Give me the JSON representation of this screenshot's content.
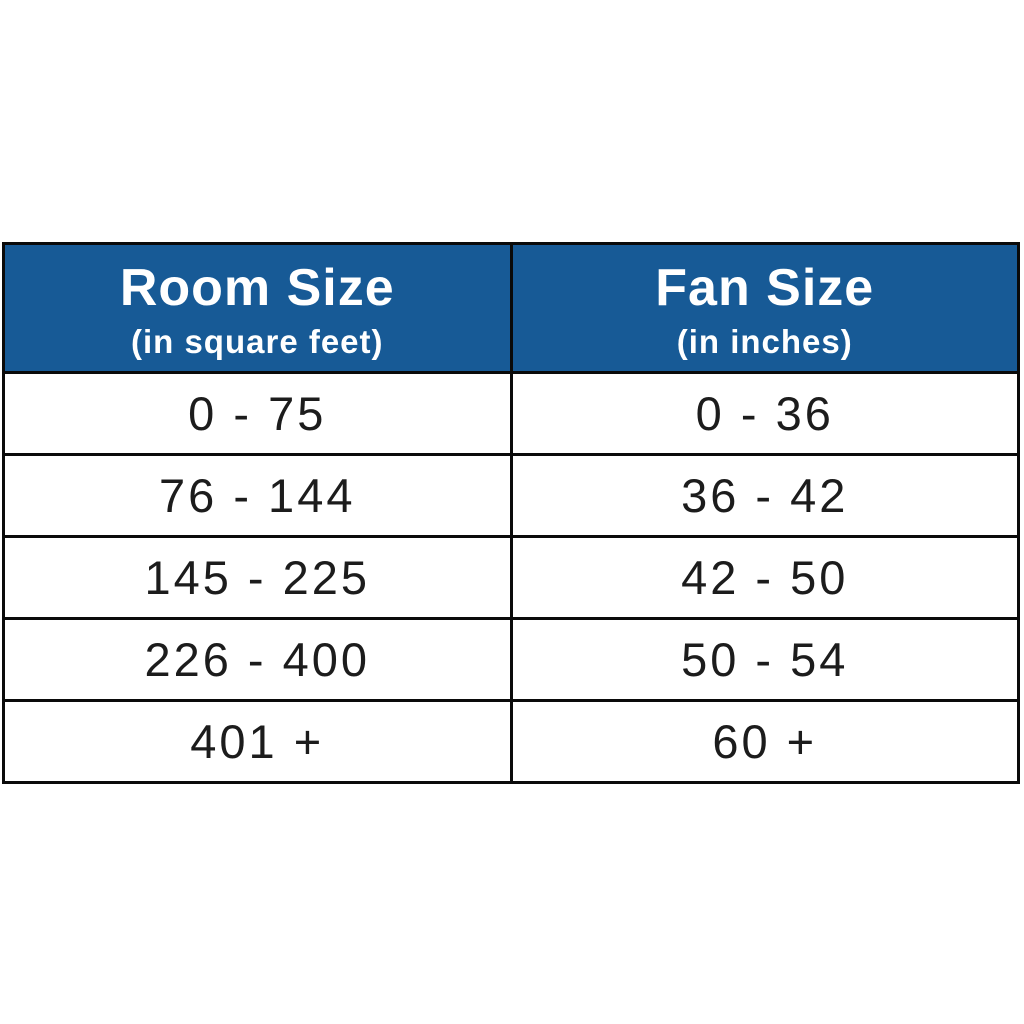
{
  "chart_data": {
    "type": "table",
    "title": "Room Size to Fan Size conversion table",
    "columns": [
      {
        "title": "Room Size",
        "subtitle": "(in square feet)"
      },
      {
        "title": "Fan Size",
        "subtitle": "(in inches)"
      }
    ],
    "rows": [
      [
        "0 - 75",
        "0 - 36"
      ],
      [
        "76 - 144",
        "36 - 42"
      ],
      [
        "145 - 225",
        "42 - 50"
      ],
      [
        "226 - 400",
        "50 - 54"
      ],
      [
        "401 +",
        "60 +"
      ]
    ],
    "colors": {
      "header_background": "#175a96",
      "header_text": "#ffffff",
      "cell_text": "#1c1c1c",
      "border": "#0a0a0a",
      "page_background": "#ffffff"
    },
    "layout": {
      "grid": "on",
      "header_rows": 1,
      "data_rows": 5,
      "column_count": 2
    }
  }
}
